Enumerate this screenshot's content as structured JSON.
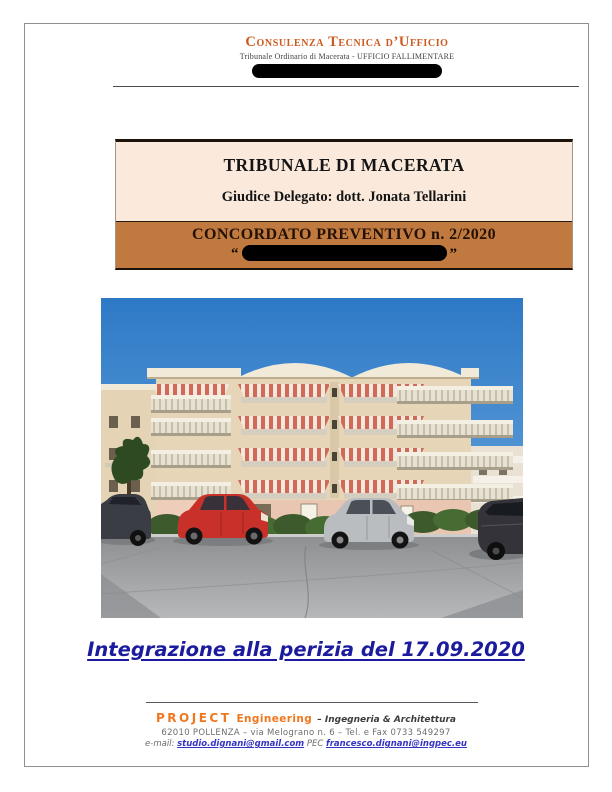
{
  "header": {
    "title": "Consulenza Tecnica d’Ufficio",
    "subtitle": "Tribunale Ordinario di Macerata - UFFICIO FALLIMENTARE"
  },
  "title_box": {
    "court": "TRIBUNALE DI MACERATA",
    "judge": "Giudice Delegato: dott. Jonata Tellarini",
    "procedure": "CONCORDATO PREVENTIVO n. 2/2020",
    "quote_open": "“",
    "quote_close": "”"
  },
  "photo": {
    "description": "street-level photo of a four-storey apartment building with balconies, striped awnings and parked cars"
  },
  "heading": {
    "text": "Integrazione alla perizia del 17.09.2020"
  },
  "footer": {
    "brand": "PROJECT",
    "brand2": "Engineering",
    "tagline": "– Ingegneria & Architettura",
    "address": "62010 POLLENZA – via Melograno n. 6 – Tel. e Fax 0733 549297",
    "email_label": "e-mail:",
    "email": "studio.dignani@gmail.com",
    "pec_label": "PEC",
    "pec": "francesco.dignani@ingpec.eu"
  },
  "colors": {
    "header_orange": "#cc5a1f",
    "banner_orange": "#c0793f",
    "box_cream": "#fbeadc",
    "heading_blue": "#1b1b9e",
    "brand_orange": "#f0771e",
    "link_blue": "#3434c4",
    "redaction_black": "#000000"
  }
}
